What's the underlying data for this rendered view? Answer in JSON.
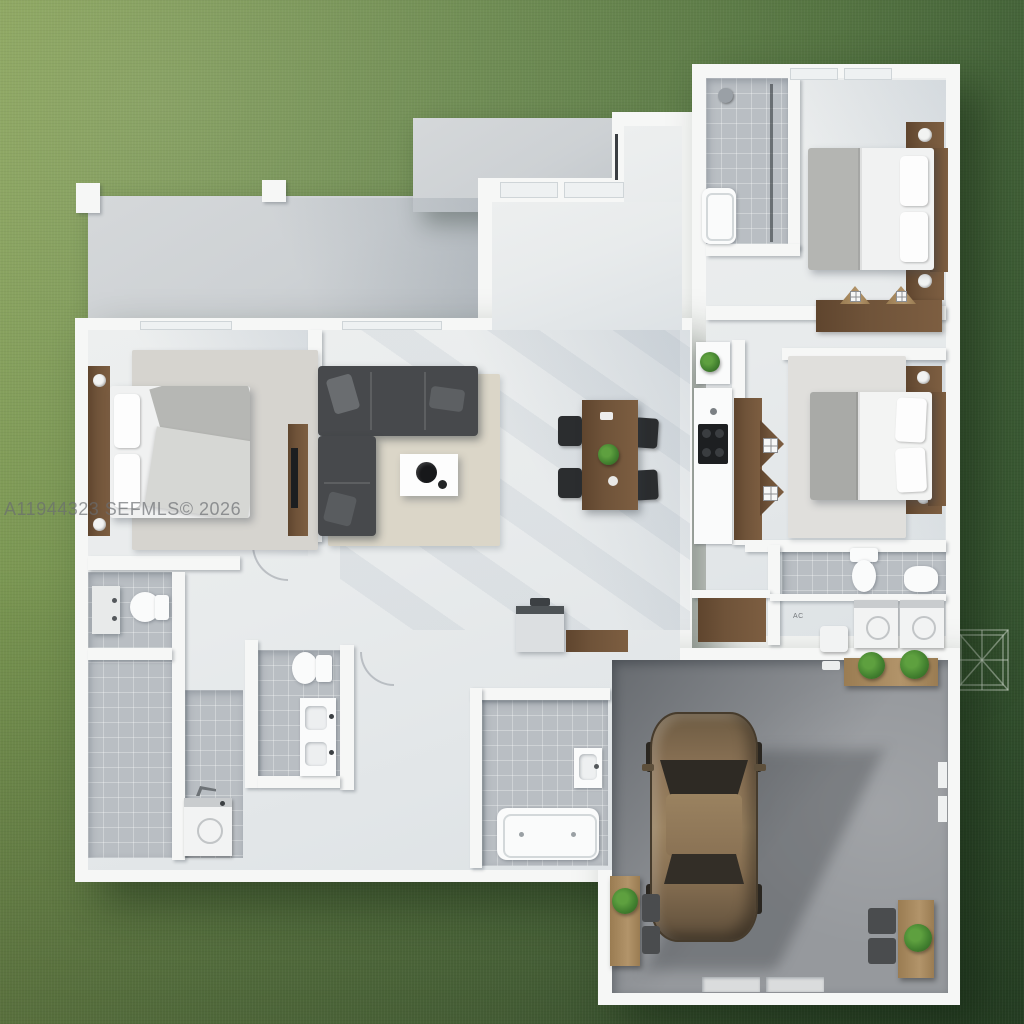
{
  "watermark": {
    "text": "A11944323 SEFMLS© 2026"
  },
  "labels": {
    "ac_closet": "AC"
  },
  "palette": {
    "grass_light": "#86a156",
    "grass_mid": "#66854a",
    "grass_dark": "#2f4e2c",
    "concrete": "#cdd1d4",
    "wall": "#f6f7f6",
    "floor": "#e8ebec",
    "tile": "#b9bec3",
    "garage_floor": "#96999d",
    "wood": "#6f5339",
    "wood_light": "#b2946a",
    "sofa": "#47494c",
    "rug_beige": "#dbd6c8",
    "rug_gray": "#d6d4cf",
    "fixture_white": "#fafbfb",
    "plant_green": "#42802f",
    "car_bronze": "#8d7457",
    "watermark_gray": "#6a6d71"
  },
  "scene": {
    "description": "Top-down 3D rendered floor plan of a single-story three-bedroom house with attached two-car garage on a grass lot",
    "rooms": [
      "lawn",
      "patio",
      "entry-walkway",
      "foyer",
      "living-room",
      "dining-area",
      "kitchen",
      "master-bedroom",
      "bedroom-2",
      "bedroom-3",
      "ensuite-bathroom",
      "master-bathroom",
      "double-vanity-bathroom",
      "tub-bathroom",
      "hall-bathroom",
      "laundry-nook",
      "utility-room",
      "flex-room",
      "garage",
      "trellis-pad"
    ],
    "furniture": [
      "bed",
      "nightstand",
      "table-lamp",
      "headboard",
      "dresser",
      "tv-console",
      "sectional-sofa",
      "throw-pillow",
      "coffee-table",
      "area-rug",
      "dining-table",
      "dining-chair",
      "centerpiece-plant",
      "cooktop",
      "kitchen-counter",
      "closet-hanging-clothes",
      "toilet",
      "sink-vanity",
      "bathtub",
      "shower-head",
      "shower-glass",
      "washer",
      "dryer",
      "water-heater",
      "mudroom-bench",
      "workbench",
      "potted-plant",
      "car",
      "garage-door",
      "patio-pillar",
      "trellis"
    ]
  }
}
